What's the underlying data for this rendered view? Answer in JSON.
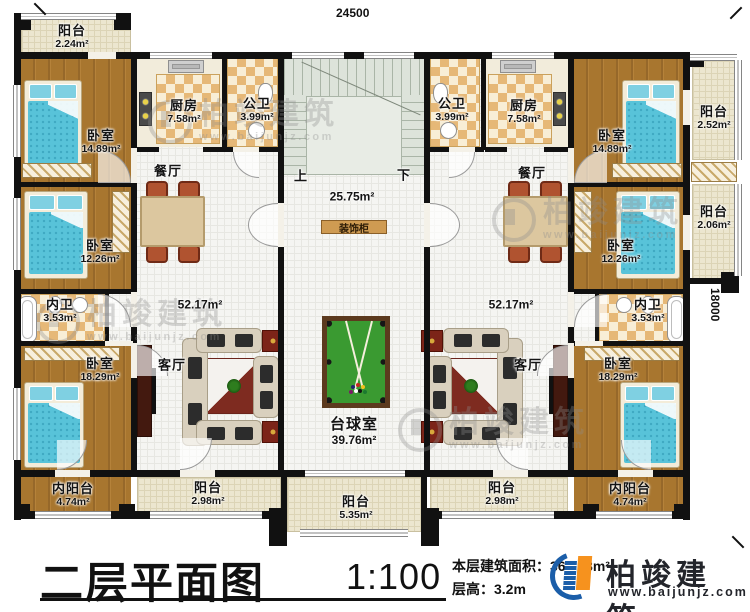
{
  "meta": {
    "dim_top": "24500",
    "dim_right": "18000"
  },
  "shared": {
    "stair_up": "上",
    "stair_down": "下",
    "hall_area": "25.75m²",
    "cabinet": "装饰柜",
    "billiard_name": "台球室",
    "billiard_area": "39.76m²",
    "balcony_center_name": "阳台",
    "balcony_center_area": "5.35m²"
  },
  "left": {
    "balcony_top": {
      "name": "阳台",
      "area": "2.24m²"
    },
    "bedroom_top": {
      "name": "卧室",
      "area": "14.89m²"
    },
    "kitchen": {
      "name": "厨房",
      "area": "7.58m²"
    },
    "bath": {
      "name": "公卫",
      "area": "3.99m²"
    },
    "dining": {
      "name": "餐厅"
    },
    "bedroom_mid": {
      "name": "卧室",
      "area": "12.26m²"
    },
    "ensuite": {
      "name": "内卫",
      "area": "3.53m²"
    },
    "living": {
      "name": "客厅",
      "area": "52.17m²"
    },
    "bedroom_bottom": {
      "name": "卧室",
      "area": "18.29m²"
    },
    "balcony_inner": {
      "name": "内阳台",
      "area": "4.74m²"
    },
    "balcony_bottom": {
      "name": "阳台",
      "area": "2.98m²"
    }
  },
  "right": {
    "bath": {
      "name": "公卫",
      "area": "3.99m²"
    },
    "kitchen": {
      "name": "厨房",
      "area": "7.58m²"
    },
    "bedroom_top": {
      "name": "卧室",
      "area": "14.89m²"
    },
    "balcony_right_top": {
      "name": "阳台",
      "area": "2.52m²"
    },
    "dining": {
      "name": "餐厅"
    },
    "bedroom_mid": {
      "name": "卧室",
      "area": "12.26m²"
    },
    "balcony_right_mid": {
      "name": "阳台",
      "area": "2.06m²"
    },
    "ensuite": {
      "name": "内卫",
      "area": "3.53m²"
    },
    "living": {
      "name": "客厅",
      "area": "52.17m²"
    },
    "bedroom_bottom": {
      "name": "卧室",
      "area": "18.29m²"
    },
    "balcony_inner": {
      "name": "内阳台",
      "area": "4.74m²"
    },
    "balcony_bottom": {
      "name": "阳台",
      "area": "2.98m²"
    }
  },
  "title_block": {
    "title": "二层平面图",
    "scale": "1:100",
    "floor_area": "本层建筑面积：360.98m²",
    "floor_height": "层高：3.2m"
  },
  "brand": {
    "name": "柏竣建筑",
    "url": "www.baijunjz.com"
  },
  "watermark": {
    "name": "柏竣建筑",
    "url": "www.baijunjz.com"
  },
  "colors": {
    "accent_blue": "#1b5ea9",
    "accent_orange": "#f6921e",
    "wall": "#111111",
    "wood": "#a8762f",
    "felt_green": "#3a9a31"
  }
}
